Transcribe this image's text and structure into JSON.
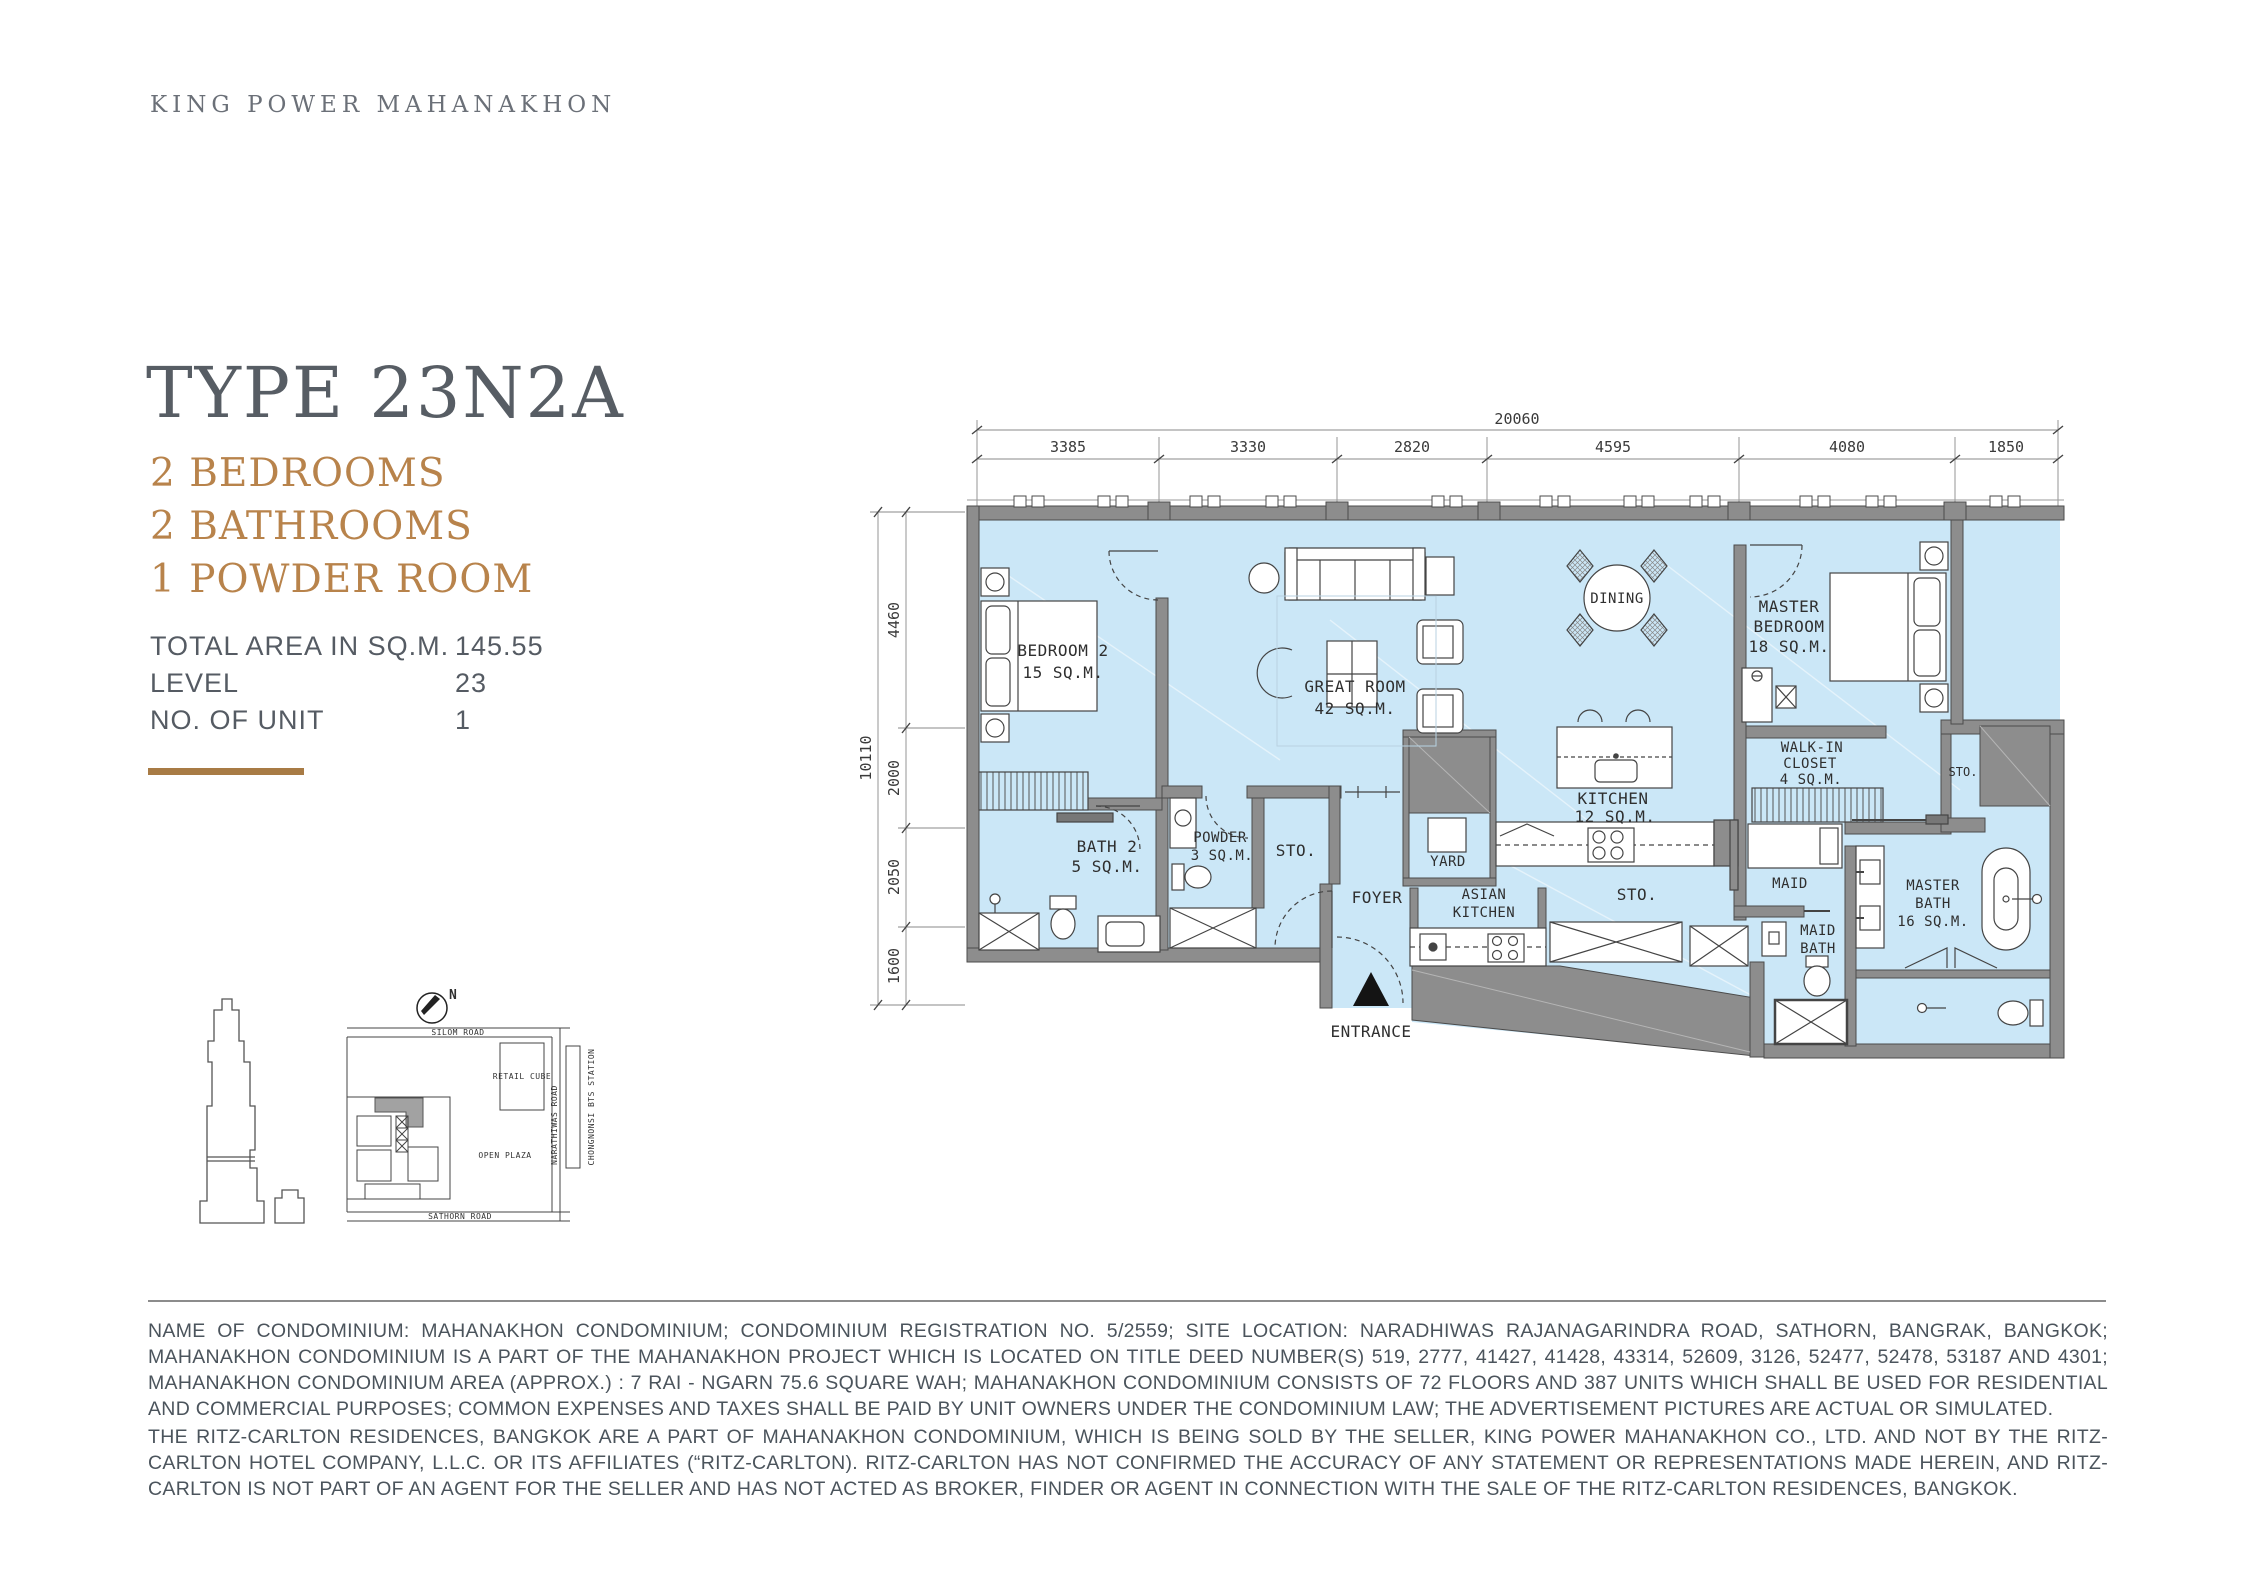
{
  "brand": {
    "logo": "KING POWER MAHANAKHON"
  },
  "unit": {
    "type_label": "TYPE 23N2A",
    "features": [
      "2 BEDROOMS",
      "2 BATHROOMS",
      "1  POWDER ROOM"
    ],
    "specs": [
      {
        "label": "TOTAL AREA IN SQ.M.",
        "value": "145.55"
      },
      {
        "label": "LEVEL",
        "value": "23"
      },
      {
        "label": "NO. OF UNIT",
        "value": "1"
      }
    ]
  },
  "colors": {
    "accent_gold": "#b8834b",
    "plan_fill": "#cbe7f7",
    "wall_gray": "#8d8d8d"
  },
  "floorplan": {
    "dims_top": {
      "overall": "20060",
      "segments": [
        "3385",
        "3330",
        "2820",
        "4595",
        "4080",
        "1850"
      ]
    },
    "dims_left": {
      "overall": "10110",
      "segments": [
        "4460",
        "2000",
        "2050",
        "1600"
      ]
    },
    "labels": {
      "bedroom2": "BEDROOM 2",
      "bedroom2_area": "15 SQ.M.",
      "great_room": "GREAT ROOM",
      "great_room_area": "42 SQ.M.",
      "dining": "DINING",
      "master_1": "MASTER",
      "master_2": "BEDROOM",
      "master_area": "18 SQ.M.",
      "bath2": "BATH 2",
      "bath2_area": "5 SQ.M.",
      "powder": "POWDER",
      "powder_area": "3 SQ.M.",
      "sto_mid": "STO.",
      "walkin_1": "WALK-IN",
      "walkin_2": "CLOSET",
      "walkin_area": "4 SQ.M.",
      "sto_right": "STO.",
      "kitchen": "KITCHEN",
      "kitchen_area": "12 SQ.M.",
      "yard": "YARD",
      "maid": "MAID",
      "foyer": "FOYER",
      "asian_1": "ASIAN",
      "asian_2": "KITCHEN",
      "sto_corridor": "STO.",
      "maidbath_1": "MAID",
      "maidbath_2": "BATH",
      "masterbath_1": "MASTER",
      "masterbath_2": "BATH",
      "masterbath_area": "16 SQ.M.",
      "entrance": "ENTRANCE"
    }
  },
  "siteplan": {
    "north": "N",
    "roads": {
      "silom": "SILOM ROAD",
      "sathorn": "SATHORN ROAD",
      "narathiwas": "NARATHIWAS ROAD",
      "bts": "CHONGNONSI BTS STATION"
    },
    "labels": {
      "retail": "RETAIL CUBE",
      "plaza": "OPEN  PLAZA"
    }
  },
  "disclaimer": {
    "p1": "NAME OF CONDOMINIUM: MAHANAKHON CONDOMINIUM; CONDOMINIUM REGISTRATION NO. 5/2559; SITE LOCATION: NARADHIWAS RAJANAGARINDRA ROAD, SATHORN, BANGRAK, BANGKOK; MAHANAKHON CONDOMINIUM IS A PART OF THE MAHANAKHON PROJECT WHICH IS LOCATED ON TITLE DEED NUMBER(S) 519, 2777, 41427, 41428, 43314, 52609, 3126, 52477, 52478, 53187 AND 4301; MAHANAKHON CONDOMINIUM AREA (APPROX.) : 7 RAI - NGARN 75.6 SQUARE WAH; MAHANAKHON CONDOMINIUM CONSISTS OF 72 FLOORS AND 387 UNITS WHICH SHALL BE USED FOR RESIDENTIAL AND COMMERCIAL PURPOSES; COMMON EXPENSES AND TAXES SHALL BE PAID BY UNIT OWNERS UNDER THE CONDOMINIUM LAW; THE ADVERTISEMENT PICTURES ARE ACTUAL OR SIMULATED.",
    "p2": "THE RITZ-CARLTON RESIDENCES, BANGKOK ARE A PART OF MAHANAKHON CONDOMINIUM, WHICH IS BEING SOLD BY THE SELLER, KING POWER MAHANAKHON CO., LTD. AND NOT BY THE RITZ-CARLTON HOTEL COMPANY, L.L.C. OR ITS AFFILIATES (“RITZ-CARLTON). RITZ-CARLTON HAS NOT CONFIRMED THE ACCURACY OF ANY STATEMENT OR REPRESENTATIONS MADE HEREIN, AND RITZ-CARLTON IS NOT PART OF AN AGENT FOR THE SELLER AND HAS NOT ACTED AS BROKER, FINDER OR AGENT IN CONNECTION WITH THE SALE OF THE RITZ-CARLTON RESIDENCES, BANGKOK."
  }
}
